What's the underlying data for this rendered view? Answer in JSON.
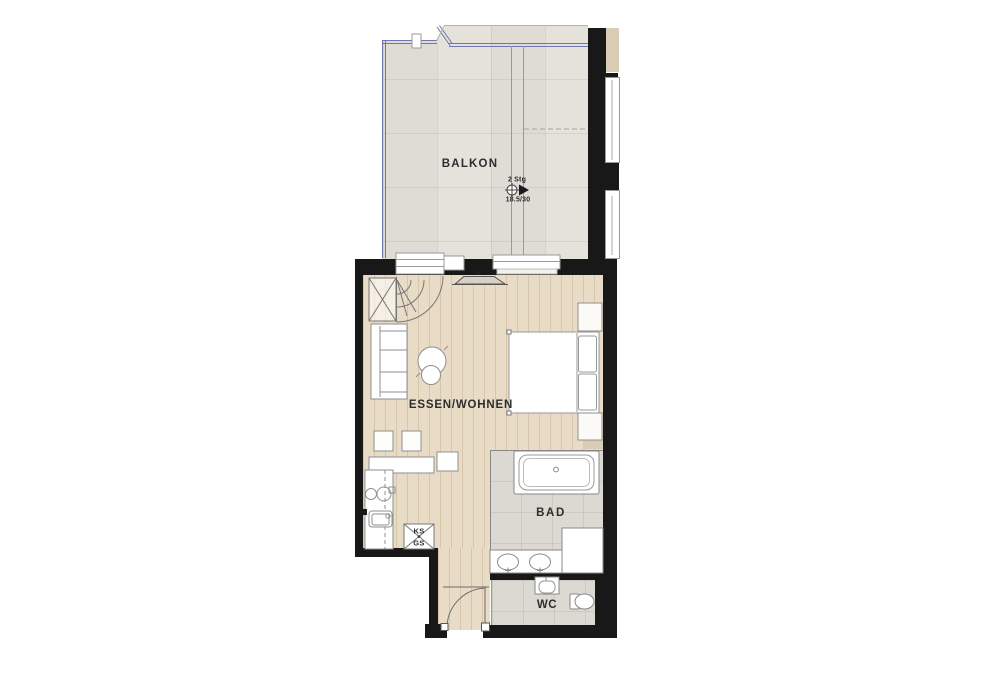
{
  "plan": {
    "balcony_label": "BALKON",
    "living_label": "ESSEN/WOHNEN",
    "bath_label": "BAD",
    "wc_label": "WC",
    "fridge_label": "KS",
    "dishwasher_label": "GS",
    "steps_count_label": "2 Stg",
    "step_dimension_label": "18.5/30"
  },
  "colors": {
    "wall": "#181818",
    "wood_floor": "#e9dcc6",
    "balcony_tile": "#e4e1db",
    "bath_tile": "#dcd8d2",
    "railing_blue": "#6f74b3",
    "partition_beige": "#d9cdb6",
    "furniture_line": "#8f8f8f",
    "label_text": "#2d2d2d"
  }
}
